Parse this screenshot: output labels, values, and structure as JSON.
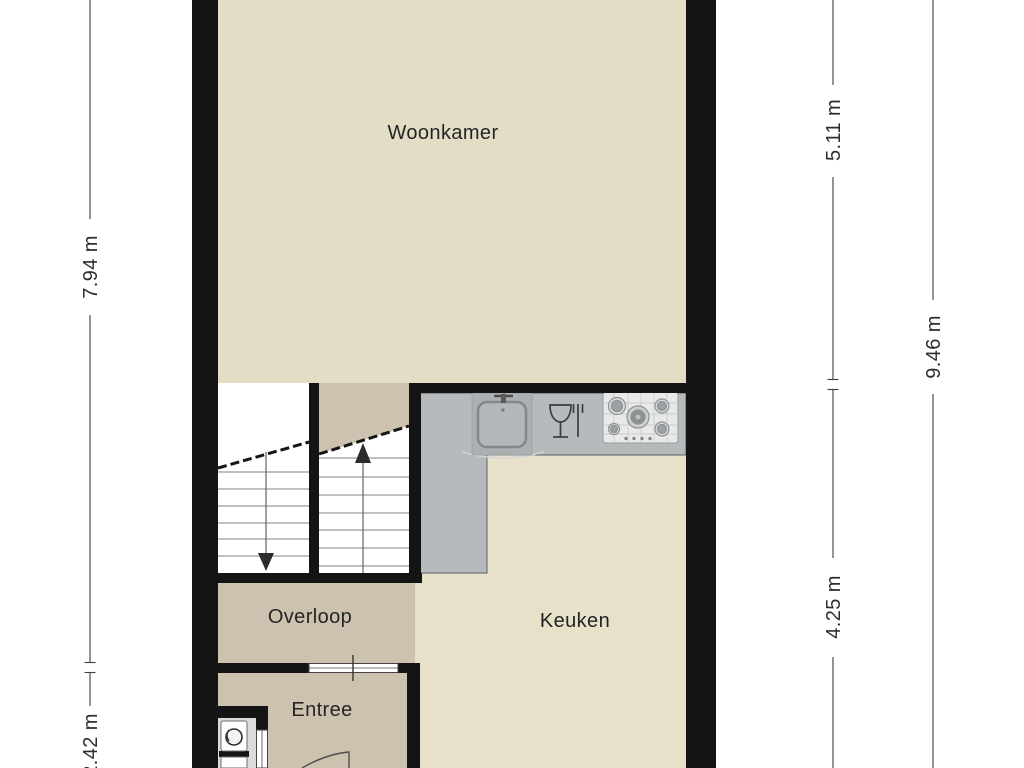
{
  "plan_title": "first-floor-plan",
  "rooms": {
    "woonkamer": "Woonkamer",
    "overloop": "Overloop",
    "keuken": "Keuken",
    "entree": "Entree"
  },
  "dimensions": {
    "left_total": "7.94 m",
    "left_bottom": "2.42 m",
    "right_top": "5.11 m",
    "right_bottom": "4.25 m",
    "right_total": "9.46 m"
  },
  "icons": {
    "sink": "rounded-basin-with-faucet",
    "dishwasher": "wine-glass-and-fork",
    "stove": "five-burner-gas-hob",
    "toilet": "top-view-toilet",
    "stairs_up": "arrow-up",
    "stairs_down": "arrow-down",
    "door_swing": "quarter-circle-arc"
  },
  "colors": {
    "wall": "#141414",
    "floor_living": "#e3ddc6",
    "floor_kitchen": "#e7e1c9",
    "floor_hall": "#cdc1af",
    "floor_wc": "#dcdbd7",
    "stair_white": "#ffffff",
    "counter": "#b7babc",
    "counter_module": "#adb0b2",
    "stove_panel": "#e8e9e9",
    "dim_line": "#3c3c3c"
  }
}
